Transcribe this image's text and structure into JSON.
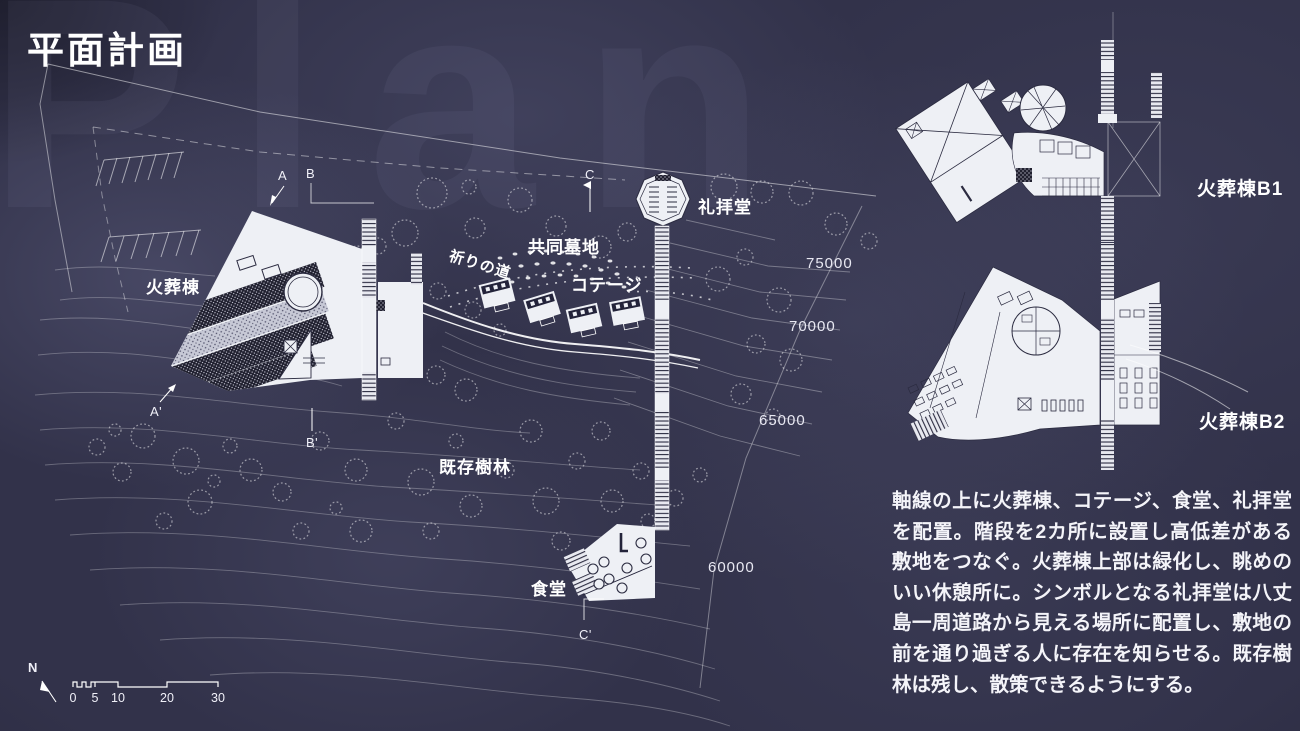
{
  "slide": {
    "title": "平面計画",
    "ghost_title": "Plan"
  },
  "site_plan": {
    "labels": {
      "crematorium": "火葬棟",
      "cemetery": "共同墓地",
      "prayer_path": "祈りの道",
      "cottage": "コテージ",
      "chapel": "礼拝堂",
      "existing_forest": "既存樹林",
      "dining": "食堂"
    },
    "contours": {
      "c75": "75000",
      "c70": "70000",
      "c65": "65000",
      "c60": "60000"
    },
    "sections": {
      "a": "A",
      "b": "B",
      "c": "C",
      "a2": "A'",
      "b2": "B'",
      "c2": "C'"
    }
  },
  "floor_plans": {
    "b1_label": "火葬棟B1",
    "b2_label": "火葬棟B2"
  },
  "description": {
    "text": "軸線の上に火葬棟、コテージ、食堂、礼拝堂を配置。階段を2カ所に設置し高低差がある敷地をつなぐ。火葬棟上部は緑化し、眺めのいい休憩所に。シンボルとなる礼拝堂は八丈島一周道路から見える場所に配置し、敷地の前を通り過ぎる人に存在を知らせる。既存樹林は残し、散策できるようにする。"
  },
  "scale_bar": {
    "north_label": "N",
    "ticks": [
      "0",
      "5",
      "10",
      "20",
      "30"
    ]
  },
  "colors": {
    "background": "#32324a",
    "line": "#ffffff",
    "building_fill": "#eef0f5",
    "detail_dark": "#23233a",
    "text": "#ffffff"
  }
}
